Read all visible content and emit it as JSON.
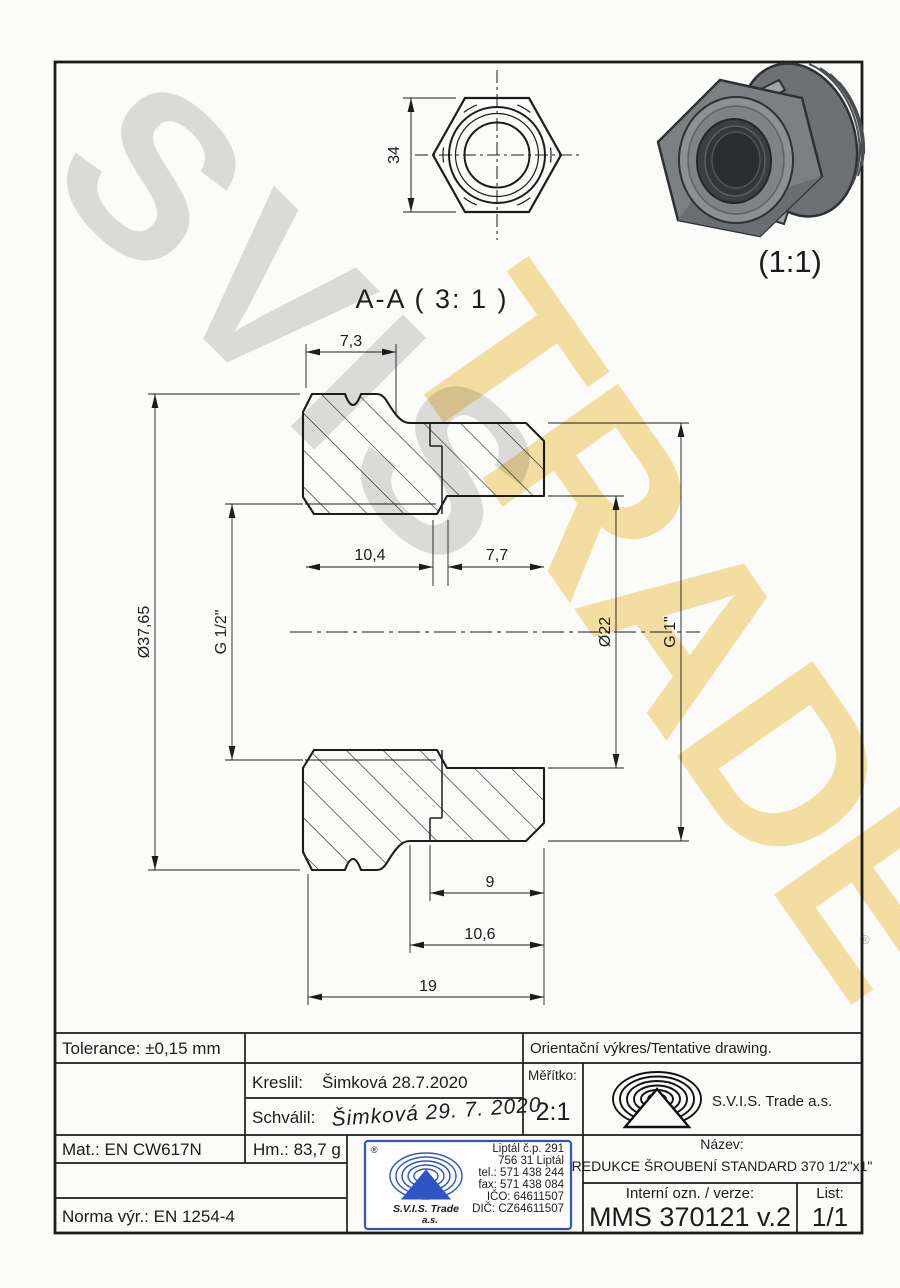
{
  "drawing": {
    "watermark": {
      "word1": "SVIS",
      "word2": "TRADE",
      "registered": "®"
    },
    "section_label": "A-A ( 3: 1 )",
    "detail_scale": "(1:1)",
    "top_view": {
      "across_flats": "34"
    },
    "section_view": {
      "dims": {
        "hex_thickness": "7,3",
        "outer_diameter": "Ø37,65",
        "thread_small": "G 1/2\"",
        "depth_small": "10,4",
        "depth_large": "7,7",
        "bore_diameter": "Ø22",
        "thread_large": "G 1\"",
        "thread_length": "9",
        "step_length": "10,6",
        "total_length": "19"
      }
    }
  },
  "title_block": {
    "tolerance": "Tolerance: ±0,15 mm",
    "orientation_note": "Orientační výkres/Tentative drawing.",
    "drawn_label": "Kreslil:",
    "drawn_value": "Šimková 28.7.2020",
    "approved_label": "Schválil:",
    "approved_signature": "Šimková 29. 7. 2020",
    "scale_label": "Měřítko:",
    "scale_value": "2:1",
    "company": "S.V.I.S. Trade a.s.",
    "material": "Mat.: EN CW617N",
    "weight": "Hm.: 83,7 g",
    "production_norm": "Norma výr.: EN 1254-4",
    "name_label": "Název:",
    "name_value": "REDUKCE ŠROUBENÍ STANDARD 370 1/2\"x1\"",
    "internal_label": "Interní ozn. / verze:",
    "internal_value": "MMS 370121 v.2",
    "sheet_label": "List:",
    "sheet_value": "1/1",
    "stamp": {
      "registered": "®",
      "company": "S.V.I.S. Trade",
      "company_suffix": "a.s.",
      "address_lines": [
        "Liptál č.p. 291",
        "756 31 Liptál",
        "tel.: 571 438 244",
        "fax: 571 438 084",
        "IČO: 64611507",
        "DIČ: CZ64611507"
      ]
    }
  },
  "colors": {
    "line": "#1c1c1c",
    "stamp_blue": "#2f55c5",
    "watermark_gray": "#c9c9c9",
    "watermark_yellow": "#f3cd69",
    "signature_blue": "#3949ab"
  }
}
